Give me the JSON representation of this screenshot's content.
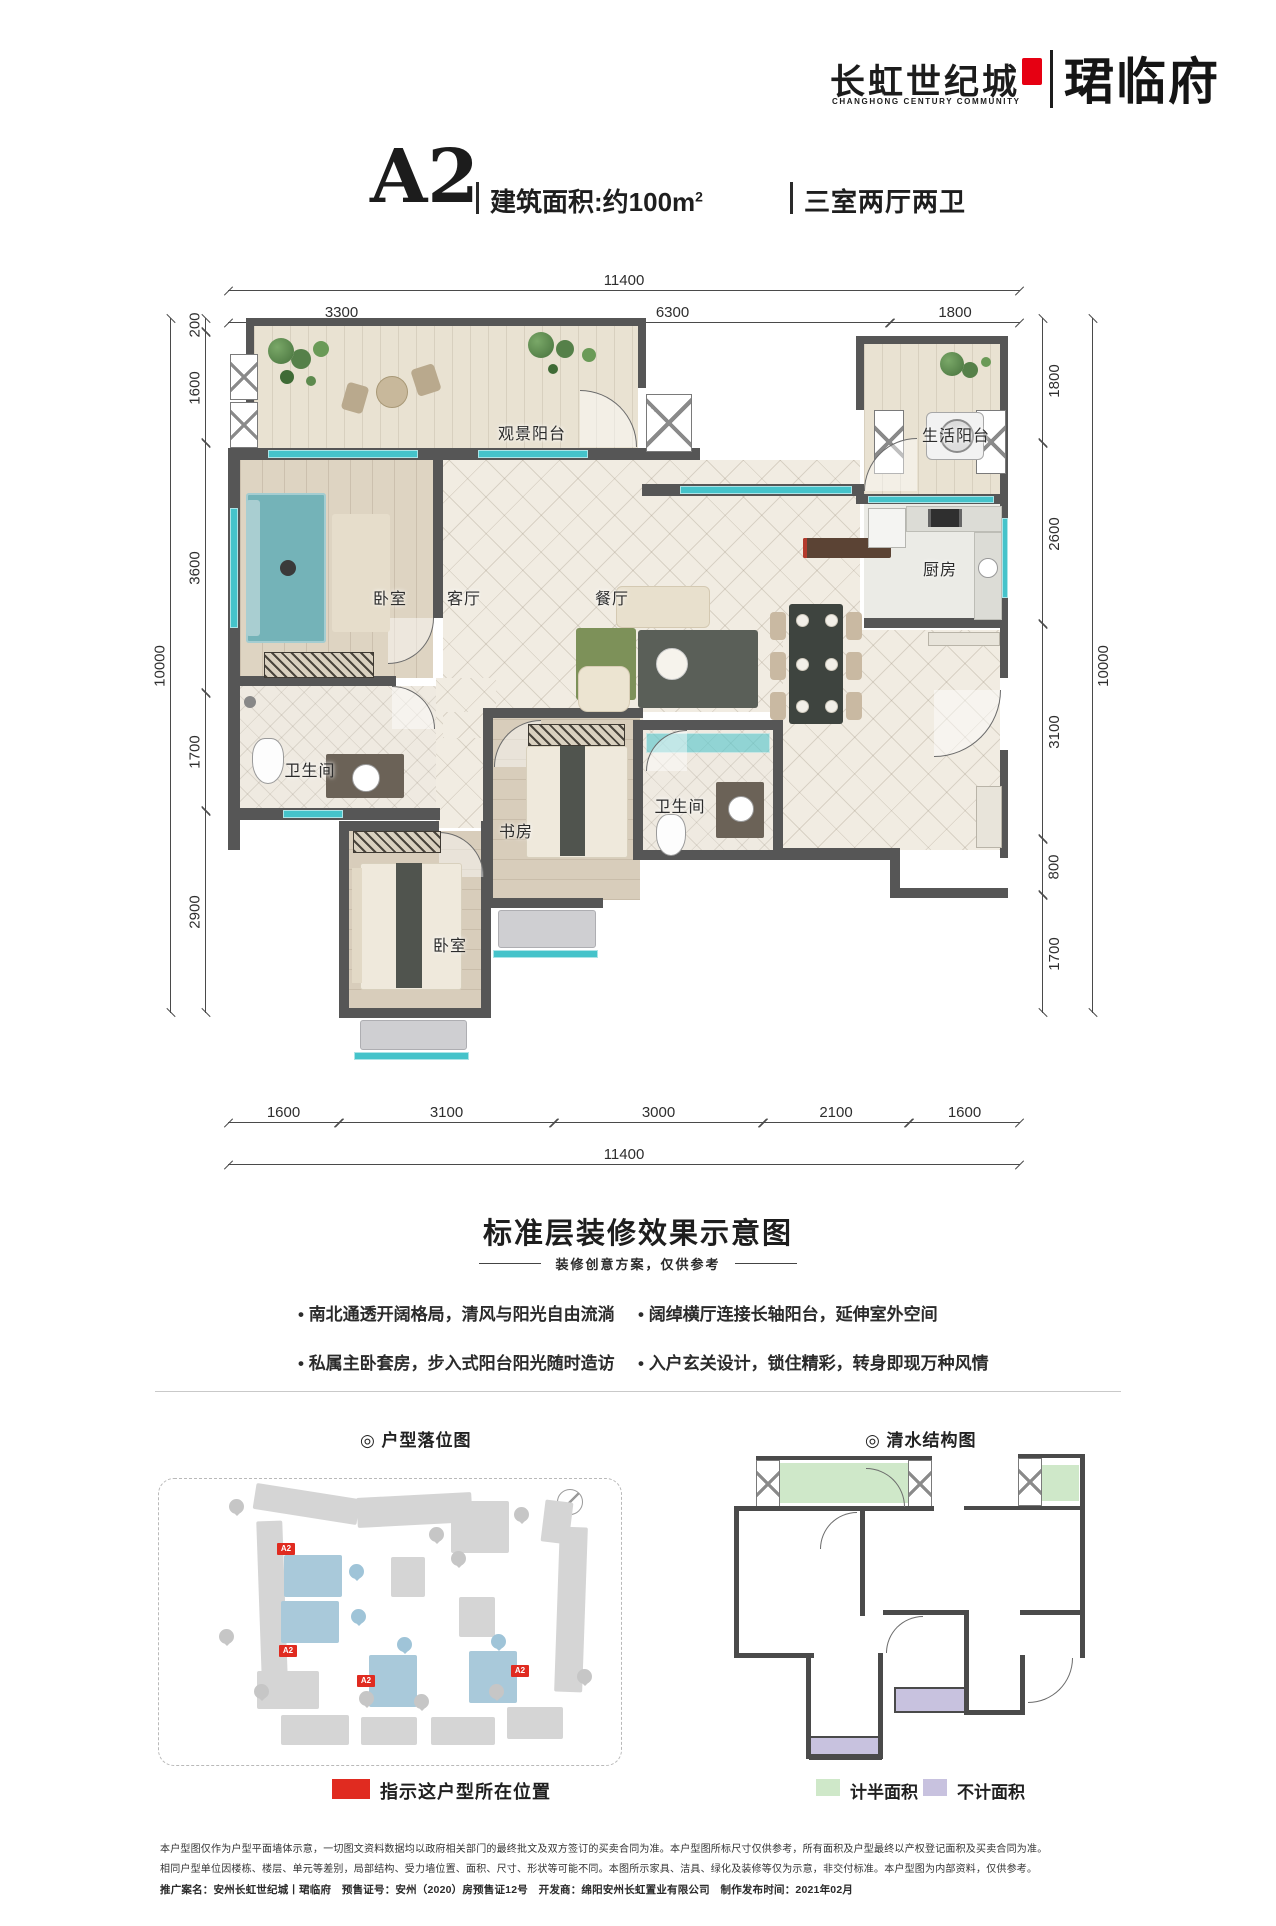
{
  "brand": {
    "name_cn": "长虹世纪城",
    "name_en": "CHANGHONG CENTURY COMMUNITY",
    "project": "珺临府"
  },
  "header_title": {
    "unit": "A2",
    "area": "建筑面积:约100m",
    "area_sup": "2",
    "rooms": "三室两厅两卫"
  },
  "plan": {
    "rooms": {
      "view_balcony": "观景阳台",
      "life_balcony": "生活阳台",
      "bedroom_master": "卧室",
      "living": "客厅",
      "dining": "餐厅",
      "kitchen": "厨房",
      "bath_master": "卫生间",
      "bath_guest": "卫生间",
      "study": "书房",
      "bedroom_second": "卧室"
    },
    "dims": {
      "top_total": "11400",
      "top_segments": [
        "3300",
        "6300",
        "1800"
      ],
      "bottom_total": "11400",
      "bottom_segments": [
        "1600",
        "3100",
        "3000",
        "2100",
        "1600"
      ],
      "left_total": "10000",
      "left_segments": [
        "200",
        "1600",
        "3600",
        "1700",
        "2900"
      ],
      "right_total": "10000",
      "right_segments": [
        "1800",
        "2600",
        "3100",
        "800",
        "1700"
      ]
    }
  },
  "effect_section": {
    "heading": "标准层装修效果示意图",
    "subheading": "装修创意方案，仅供参考",
    "bullets": [
      "南北通透开阔格局，清风与阳光自由流淌",
      "阔绰横厅连接长轴阳台，延伸室外空间",
      "私属主卧套房，步入式阳台阳光随时造访",
      "入户玄关设计，锁住精彩，转身即现万种风情"
    ]
  },
  "location_map": {
    "title": "◎ 户型落位图",
    "unit_tag": "A2",
    "legend": "指示这户型所在位置"
  },
  "structure_map": {
    "title": "◎ 清水结构图",
    "legend_half": "计半面积",
    "legend_excluded": "不计面积"
  },
  "disclaimer": {
    "line1": "本户型图仅作为户型平面墙体示意，一切图文资料数据均以政府相关部门的最终批文及双方签订的买卖合同为准。本户型图所标尺寸仅供参考，所有面积及户型最终以产权登记面积及买卖合同为准。",
    "line2": "相同户型单位因楼栋、楼层、单元等差别，局部结构、受力墙位置、面积、尺寸、形状等可能不同。本图所示家具、洁具、绿化及装修等仅为示意，非交付标准。本户型图为内部资料，仅供参考。",
    "line3": "推广案名：安州长虹世纪城丨珺临府　预售证号：安州（2020）房预售证12号　开发商：绵阳安州长虹置业有限公司　制作发布时间：2021年02月"
  },
  "colors": {
    "accent_red": "#e60012",
    "window_teal": "#45c3ca",
    "wall_gray": "#565656",
    "half_area_green": "#cfe8c9",
    "excluded_purple": "#c8c2df",
    "marker_red": "#e02b20",
    "building_blue": "#a9c9da"
  }
}
